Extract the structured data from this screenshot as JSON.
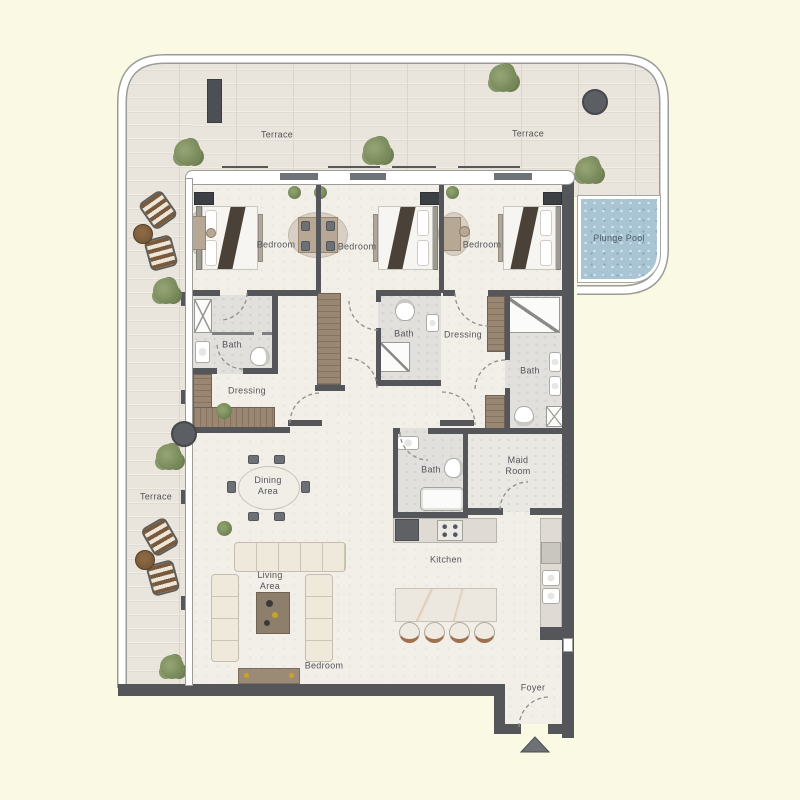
{
  "plan_type": "apartment-floor-plan",
  "colors": {
    "background": "#FAF9E4",
    "terrace_wood": "#E9E5DC",
    "unit_floor": "#F2EFE8",
    "bath_floor": "#E1E0DC",
    "wall": "#54565A",
    "wardrobe_wood": "#9A8773",
    "pool_water": "#A9C5D3",
    "border_band": "#FFFFFF",
    "label_text": "#55555A",
    "greenery": "#7D8E5E",
    "lounger_wood": "#7A5A3C"
  },
  "rooms": {
    "terrace_top_left": {
      "label": "Terrace"
    },
    "terrace_top_right": {
      "label": "Terrace"
    },
    "terrace_left": {
      "label": "Terrace"
    },
    "plunge_pool": {
      "label": "Plunge Pool"
    },
    "bedroom_1": {
      "label": "Bedroom"
    },
    "bedroom_2": {
      "label": "Bedroom"
    },
    "bedroom_3": {
      "label": "Bedroom"
    },
    "bath_1": {
      "label": "Bath"
    },
    "bath_2": {
      "label": "Bath"
    },
    "bath_3": {
      "label": "Bath"
    },
    "bath_maid": {
      "label": "Bath"
    },
    "dressing_1": {
      "label": "Dressing"
    },
    "dressing_2": {
      "label": "Dressing"
    },
    "maid_room": {
      "label": "Maid Room"
    },
    "kitchen": {
      "label": "Kitchen"
    },
    "dining_area": {
      "label": "Dining Area"
    },
    "living_area": {
      "label": "Living Area"
    },
    "living_bedroom": {
      "label": "Bedroom"
    },
    "foyer": {
      "label": "Foyer"
    }
  }
}
